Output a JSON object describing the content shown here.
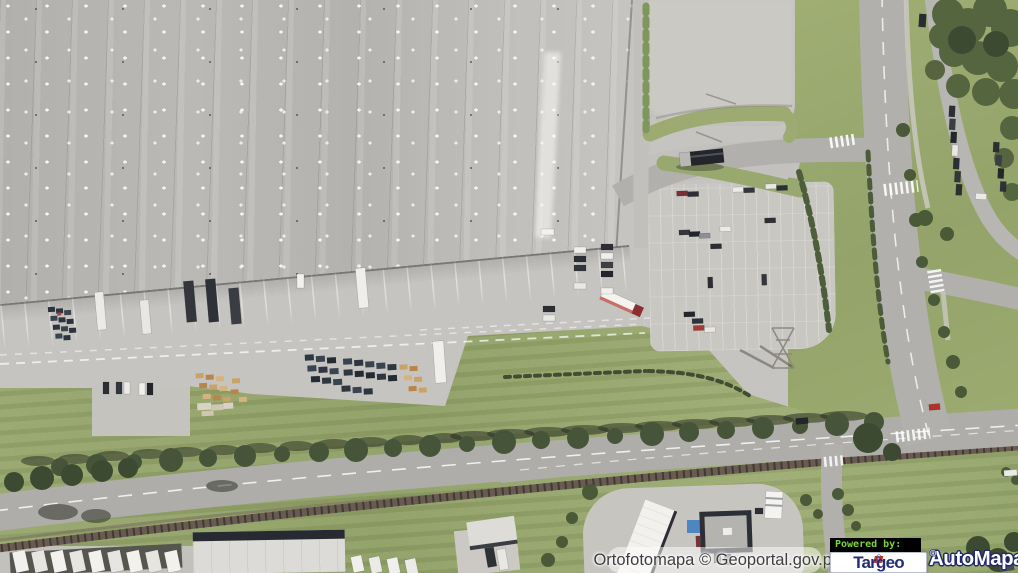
{
  "map": {
    "view_type": "orthophoto aerial map",
    "attribution": "Ortofotomapa © Geoportal.gov.pl",
    "scene": "logistics warehouse with loading docks, two parking lots, bus stop, tree-lined road, railway line and small commercial buildings"
  },
  "logos": {
    "powered_by_label": "Powered by:",
    "targeo_name": "Targeo",
    "targeo_reg": "®",
    "automapa_name": "AutoMapa",
    "automapa_reg": "®",
    "colors": {
      "powered_green": "#7bd53d",
      "targeo_navy": "#242e6f",
      "targeo_red": "#d8372e",
      "automapa_fill": "#ffffff",
      "automapa_outline": "#20296a"
    }
  },
  "palette": {
    "concrete": "#c6c4c0",
    "warehouse_roof": "#b6b4b0",
    "skylight": "#f4f3f0",
    "road_asphalt": "#b1b0ac",
    "grass": "#97a76d",
    "tree_canopy": "#465539",
    "railway": "#6a5b51"
  }
}
